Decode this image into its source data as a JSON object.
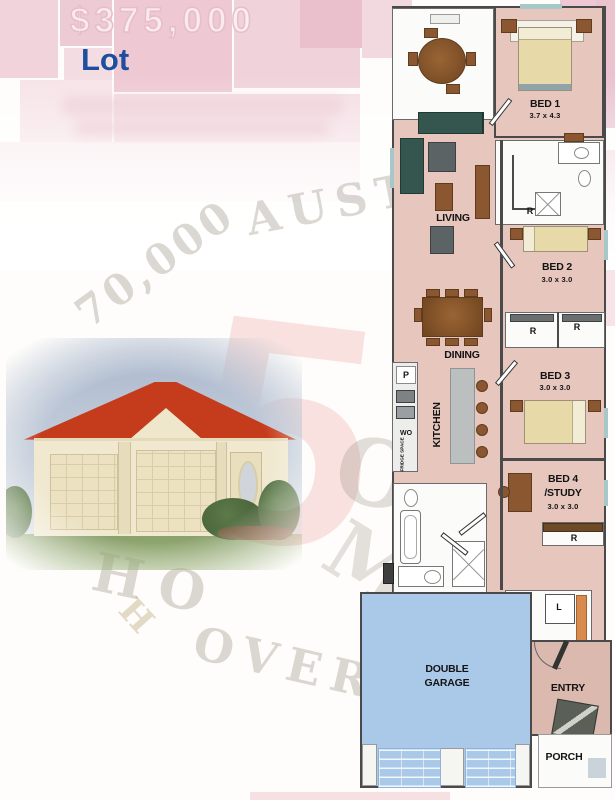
{
  "header": {
    "price_ghost": "$375,000",
    "lot_label": "Lot"
  },
  "watermark": {
    "fragments": [
      "70,000",
      "AUSTR",
      "O",
      "M",
      "HO",
      "H",
      "OVER"
    ],
    "numeral": "5"
  },
  "floorplan": {
    "rooms": {
      "bed1": {
        "name": "BED 1",
        "size": "3.7 x 4.3"
      },
      "bed2": {
        "name": "BED 2",
        "size": "3.0 x 3.0"
      },
      "bed3": {
        "name": "BED 3",
        "size": "3.0 x 3.0"
      },
      "bed4": {
        "name": "BED 4",
        "name2": "/STUDY",
        "size": "3.0 x 3.0"
      },
      "living": {
        "name": "LIVING"
      },
      "dining": {
        "name": "DINING"
      },
      "kitchen": {
        "name": "KITCHEN"
      },
      "garage": {
        "line1": "DOUBLE",
        "line2": "GARAGE"
      },
      "laundry": {
        "name": "LDY"
      },
      "entry": {
        "name": "ENTRY"
      },
      "porch": {
        "name": "PORCH"
      }
    },
    "tags": {
      "pantry": "P",
      "wall_oven": "WO",
      "fridge": "FRIDGE SPACE",
      "robe": "R",
      "tub": "L"
    }
  },
  "colors": {
    "lot_blue": "#1d4f9e",
    "floor_pink": "#e6c6bd",
    "garage_blue": "#aac9e9",
    "roof_red": "#c53c1d",
    "collage_pink": "#eecbd6",
    "watermark_gray": "#968e80"
  }
}
